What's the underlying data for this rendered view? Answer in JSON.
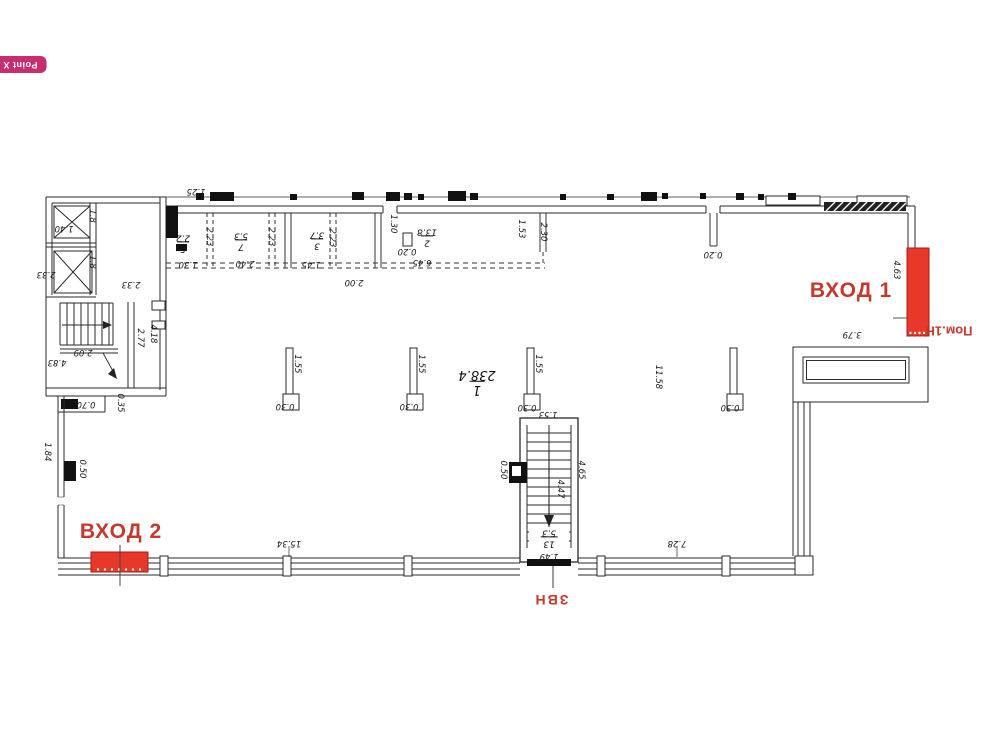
{
  "watermark": {
    "label": "Point X U"
  },
  "plan": {
    "entrance1": "ВХОД 1",
    "entrance2": "ВХОД 2",
    "room_suite": "Пом.1Н",
    "rear_entrance": "ЗВН"
  },
  "rooms": {
    "r1": {
      "number": "1",
      "area": "238.4"
    },
    "r2": {
      "number": "2",
      "area": "13.8"
    },
    "r3": {
      "number": "3",
      "area": "3.7"
    },
    "r5": {
      "number": "5",
      "area": "2.2"
    },
    "r7": {
      "number": "7",
      "area": "5.3"
    },
    "r13": {
      "number": "13",
      "area": "5.3"
    }
  },
  "dims": {
    "d125": "1.25",
    "d140": "1.40",
    "d18": "1.8",
    "d233": "2.33",
    "d209": "2.09",
    "d483": "4.83",
    "d277": "2.77",
    "d418": "4.18",
    "d070": "0.70",
    "d035": "0.35",
    "d184": "1.84",
    "d050": "0.50",
    "d223": "2.23",
    "d130": "1.30",
    "d240": "2.40",
    "d145": "1.45",
    "d200": "2.00",
    "d020": "0.20",
    "d645": "6.45",
    "d153": "1.53",
    "d230": "2.30",
    "d155": "1.55",
    "d030": "0.30",
    "d1158": "11.58",
    "d463": "4.63",
    "d379": "3.79",
    "d465": "4.65",
    "d447": "4.47",
    "d149": "1.49",
    "d1534": "15.34",
    "d728": "7.28"
  },
  "colors": {
    "accent_red": "#c4392e",
    "fill_red": "#e8382a",
    "watermark_bg": "#c82d70",
    "line": "#2a2a2a"
  }
}
